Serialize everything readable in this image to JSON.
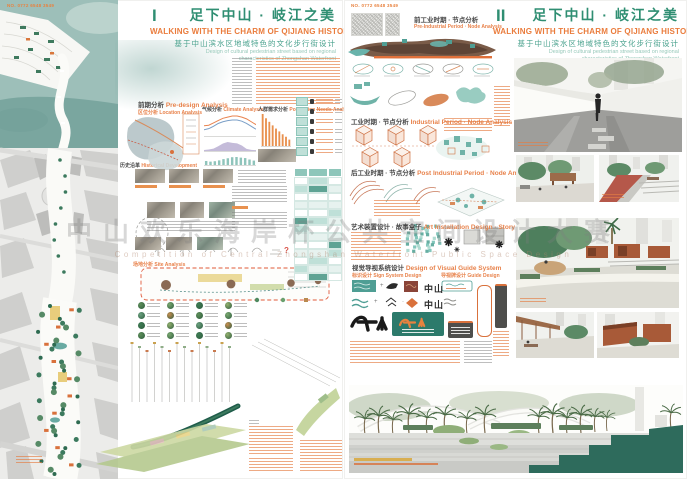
{
  "watermark": {
    "cn": "中山欢乐海岸杯公共空间设计大赛",
    "en": "Competition of Central Zhongshan Waterfront Public Space Design"
  },
  "icons": {
    "medallion": "❋",
    "medallion_small": "✳",
    "plus": "+",
    "dot": "·",
    "question": "?"
  },
  "left": {
    "plate_no": "NO. 0772 6548 3549",
    "numeral": "I",
    "title_cn": "足下中山 · 岐江之美",
    "title_en": "WALKING WITH THE CHARM OF QIJIANG HISTORY",
    "subtitle_cn": "基于中山滨水区地域特色的文化步行街设计",
    "subtitle_en1": "Design of cultural pedestrian street based on regional",
    "subtitle_en2": "characteristics of Zhongshan Waterfront",
    "sections": {
      "pre_analysis": {
        "cn": "前期分析",
        "en": "Pre-design Analysis"
      },
      "location": {
        "cn": "区位分析",
        "en": "Location Analysis"
      },
      "climate": {
        "cn": "气候分析",
        "en": "Climate Analysis"
      },
      "population": {
        "cn": "人群需求分析",
        "en": "Population Needs Analysis"
      },
      "history": {
        "cn": "历史沿革",
        "en": "Historical Development"
      },
      "site": {
        "cn": "场地分析",
        "en": "Site Analysis"
      }
    }
  },
  "right": {
    "plate_no": "NO. 0772 6548 3549",
    "numeral": "II",
    "title_cn": "足下中山 · 岐江之美",
    "title_en": "WALKING WITH THE CHARM OF QIJIANG HISTORY",
    "subtitle_cn": "基于中山滨水区地域特色的文化步行街设计",
    "subtitle_en1": "Design of cultural pedestrian street based on regional",
    "subtitle_en2": "characteristics of Zhongshan Waterfront",
    "logo_text": "中山",
    "sections": {
      "pre_industrial": {
        "cn": "前工业时期 · 节点分析",
        "en": "Pre-Industrial Period · Node Analysis"
      },
      "industrial": {
        "cn": "工业时期 · 节点分析",
        "en": "Industrial Period · Node Analysis"
      },
      "post_industrial": {
        "cn": "后工业时期 · 节点分析",
        "en": "Post Industrial Period · Node Analysis"
      },
      "art_installation": {
        "cn": "艺术装置设计 · 故事盒子",
        "en": "Art Installation Design · Story Box"
      },
      "visual_guide": {
        "cn": "视觉导视系统设计",
        "en": "Design of Visual Guide System"
      },
      "sign_design": {
        "cn": "标识设计",
        "en": "Sign System Design"
      },
      "guide_design": {
        "cn": "导视牌设计",
        "en": "Guide Design"
      }
    }
  },
  "chart_data": [
    {
      "type": "line",
      "title": "气候分析 Climate Analysis – 气温",
      "x": [
        1,
        2,
        3,
        4,
        5,
        6,
        7,
        8,
        9,
        10,
        11,
        12
      ],
      "series": [
        {
          "name": "最高气温",
          "color": "#e8834f",
          "values": [
            16,
            17,
            21,
            25,
            29,
            31,
            33,
            33,
            31,
            28,
            23,
            18
          ]
        },
        {
          "name": "最低气温",
          "color": "#7b9fc7",
          "values": [
            9,
            11,
            15,
            20,
            23,
            25,
            26,
            26,
            24,
            20,
            15,
            10
          ]
        }
      ],
      "xlabel": "月份",
      "ylabel": "°C",
      "grid": false,
      "legend_position": "none"
    },
    {
      "type": "area",
      "title": "气候分析 Climate Analysis – 降水量",
      "x": [
        1,
        2,
        3,
        4,
        5,
        6,
        7,
        8,
        9,
        10,
        11,
        12
      ],
      "values": [
        35,
        55,
        85,
        170,
        265,
        320,
        290,
        270,
        195,
        75,
        40,
        30
      ],
      "color": "#b5aacf",
      "xlabel": "月份",
      "ylabel": "mm"
    },
    {
      "type": "bar",
      "title": "气候分析 Climate Analysis – 日照",
      "x": [
        1,
        2,
        3,
        4,
        5,
        6,
        7,
        8,
        9,
        10,
        11,
        12
      ],
      "values": [
        95,
        80,
        90,
        110,
        140,
        160,
        185,
        190,
        175,
        165,
        130,
        105
      ],
      "color": "#8fc4bb",
      "xlabel": "月份",
      "ylabel": "h"
    },
    {
      "type": "bar",
      "title": "人群需求分析 Population Needs Analysis",
      "x": [
        1,
        2,
        3,
        4,
        5,
        6,
        7,
        8,
        9
      ],
      "values": [
        90,
        78,
        68,
        58,
        49,
        41,
        33,
        26,
        18
      ],
      "color": "#e8914f",
      "ylabel": "%"
    }
  ]
}
